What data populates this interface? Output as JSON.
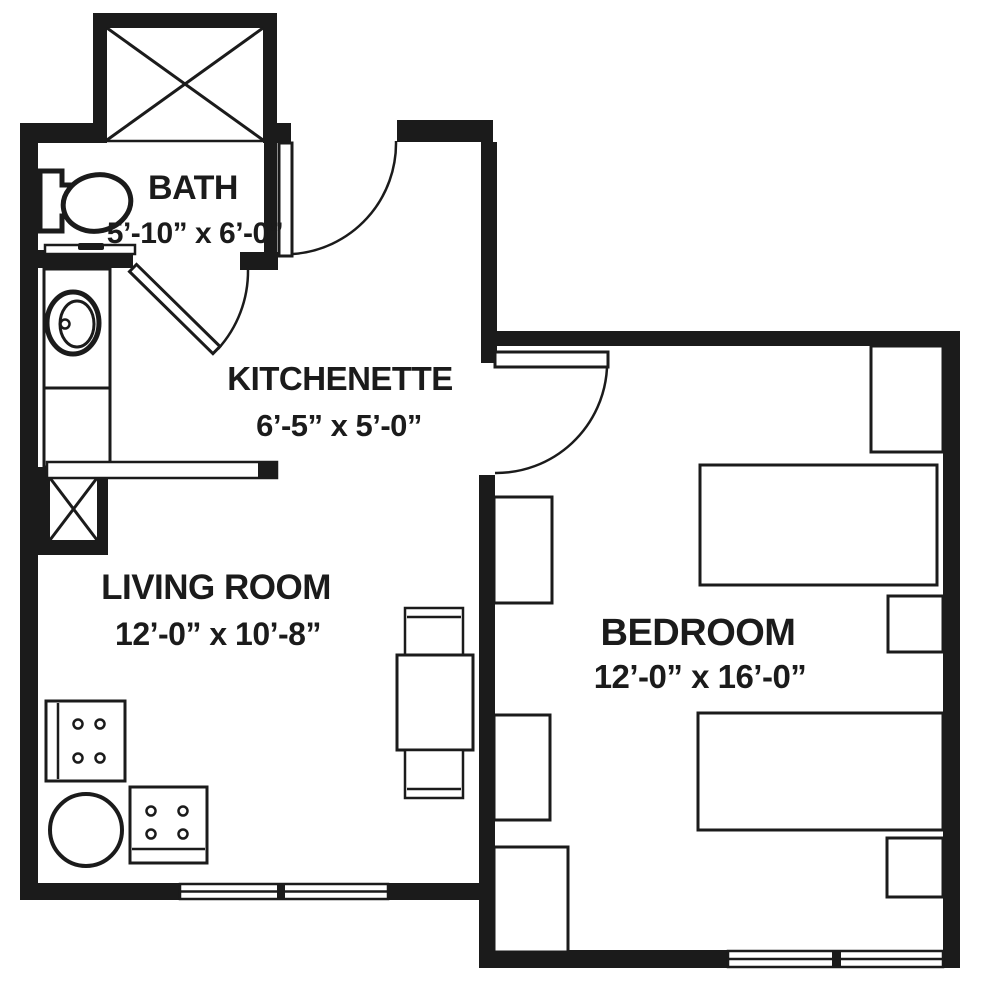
{
  "plan": {
    "background": "#ffffff",
    "ink": "#1b1b1b",
    "rooms": [
      {
        "name": "BATH",
        "dims": "5’-10” x 6’-0”"
      },
      {
        "name": "KITCHENETTE",
        "dims": "6’-5” x 5’-0”"
      },
      {
        "name": "LIVING ROOM",
        "dims": "12’-0” x 10’-8”"
      },
      {
        "name": "BEDROOM",
        "dims": "12’-0” x 16’-0”"
      }
    ]
  }
}
